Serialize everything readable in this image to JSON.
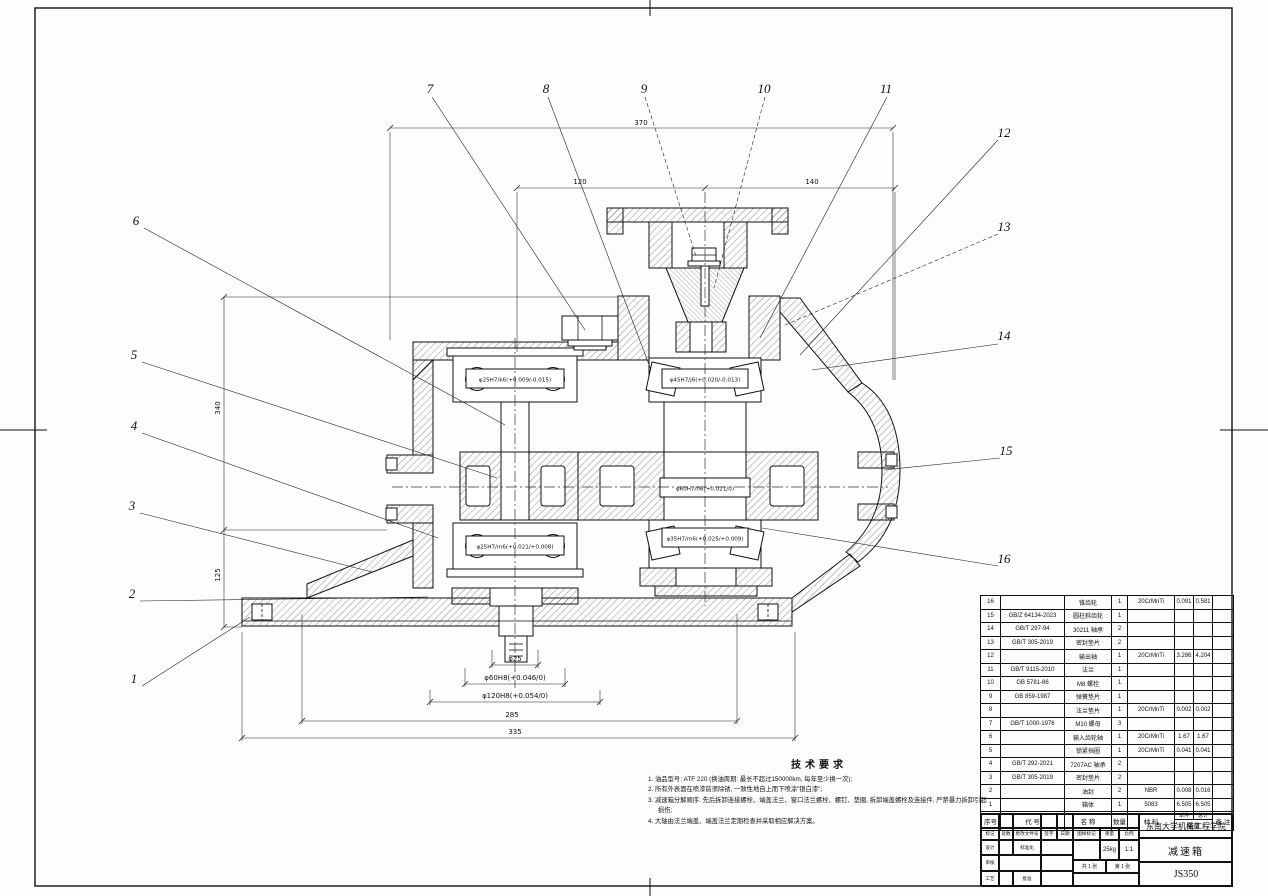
{
  "callouts": {
    "top": [
      "7",
      "8",
      "9",
      "10",
      "11"
    ],
    "right": [
      "12",
      "13",
      "14",
      "15",
      "16"
    ],
    "left": [
      "6",
      "5",
      "4",
      "3",
      "2",
      "1"
    ]
  },
  "dimensions": {
    "top_overall": "370",
    "top_left": "120",
    "top_right": "140",
    "left_upper": "340",
    "left_lower": "125",
    "bottom": [
      "φ25",
      "φ60H8(+0.046/0)",
      "φ120H8(+0.054/0)",
      "285",
      "335"
    ]
  },
  "fits": {
    "left_top": "φ25H7/k6(+0.009/-0.015)",
    "right_top": "φ45H7/j6(+0.020/-0.013)",
    "center": "φ60H7/h6(+0.021/0)",
    "right_bottom": "φ35H7/m6(+0.025/+0.009)",
    "left_bottom": "φ25H7/m6(+0.021/+0.008)"
  },
  "tech_requirements": {
    "title": "技术要求",
    "items": [
      "1. 油品型号: ATF 220 (换油周期: 最长不超过150000km, 每年至少换一次);",
      "2. 所有外表面在喷漆前须除锈, 一致性地自上而下喷涂\"银白漆\";",
      "3. 减速箱分解顺序: 先后拆卸连接螺栓、端盖法兰、窗口法兰螺栓、螺钉、垫圈, 拆卸端盖螺栓及连接件, 严禁暴力拆卸引起损伤;",
      "4. 大轴由法兰端盖、端盖法兰定期检查并采取相应解决方案。"
    ]
  },
  "bom": {
    "headers": {
      "no": "序号",
      "code": "代 号",
      "name": "名 称",
      "qty": "数量",
      "material": "材 料",
      "weight": "重量",
      "unit": "单件",
      "total": "总计",
      "remark": "备 注"
    },
    "rows": [
      {
        "no": "16",
        "code": "",
        "name": "锥齿轮",
        "qty": "1",
        "material": "20CrMnTi",
        "unit": "0.091",
        "total": "0.581",
        "remark": ""
      },
      {
        "no": "15",
        "code": "GB/Z 64134-2023",
        "name": "圆柱斜齿轮",
        "qty": "1",
        "material": "",
        "unit": "",
        "total": "",
        "remark": ""
      },
      {
        "no": "14",
        "code": "GB/T 297-94",
        "name": "30211 轴承",
        "qty": "2",
        "material": "",
        "unit": "",
        "total": "",
        "remark": ""
      },
      {
        "no": "13",
        "code": "GB/T 305-2019",
        "name": "密封垫片",
        "qty": "2",
        "material": "",
        "unit": "",
        "total": "",
        "remark": ""
      },
      {
        "no": "12",
        "code": "",
        "name": "输出轴",
        "qty": "1",
        "material": "20CrMnTi",
        "unit": "3.286",
        "total": "4.204",
        "remark": ""
      },
      {
        "no": "11",
        "code": "GB/T 9115-2010",
        "name": "法兰",
        "qty": "1",
        "material": "",
        "unit": "",
        "total": "",
        "remark": ""
      },
      {
        "no": "10",
        "code": "GB 5781-86",
        "name": "M8 螺栓",
        "qty": "1",
        "material": "",
        "unit": "",
        "total": "",
        "remark": ""
      },
      {
        "no": "9",
        "code": "GB 859-1987",
        "name": "弹簧垫片",
        "qty": "1",
        "material": "",
        "unit": "",
        "total": "",
        "remark": ""
      },
      {
        "no": "8",
        "code": "",
        "name": "法兰垫片",
        "qty": "1",
        "material": "20CrMnTi",
        "unit": "0.002",
        "total": "0.002",
        "remark": ""
      },
      {
        "no": "7",
        "code": "GB/T 1000-1976",
        "name": "M10 螺母",
        "qty": "3",
        "material": "",
        "unit": "",
        "total": "",
        "remark": ""
      },
      {
        "no": "6",
        "code": "",
        "name": "输入齿轮轴",
        "qty": "1",
        "material": "20CrMnTi",
        "unit": "1.67",
        "total": "1.67",
        "remark": ""
      },
      {
        "no": "5",
        "code": "",
        "name": "锁紧挡圈",
        "qty": "1",
        "material": "20CrMnTi",
        "unit": "0.041",
        "total": "0.041",
        "remark": ""
      },
      {
        "no": "4",
        "code": "GB/T 292-2021",
        "name": "7207AC 轴承",
        "qty": "2",
        "material": "",
        "unit": "",
        "total": "",
        "remark": ""
      },
      {
        "no": "3",
        "code": "GB/T 305-2019",
        "name": "密封垫片",
        "qty": "2",
        "material": "",
        "unit": "",
        "total": "",
        "remark": ""
      },
      {
        "no": "2",
        "code": "",
        "name": "油封",
        "qty": "2",
        "material": "NBR",
        "unit": "0.008",
        "total": "0.016",
        "remark": ""
      },
      {
        "no": "1",
        "code": "",
        "name": "箱体",
        "qty": "1",
        "material": "5083",
        "unit": "6.505",
        "total": "6.505",
        "remark": ""
      }
    ]
  },
  "title_block": {
    "org": "东南大学机械工程学院",
    "part_name": "减速箱",
    "drawing_no": "JS350",
    "stage_label": "图样标记",
    "weight_label": "重量",
    "weight": "25kg",
    "scale_label": "比例",
    "scale": "1:1",
    "sheets": "共 1 张",
    "sheet_no": "第 1 张",
    "fields": {
      "mark": "标记",
      "count": "处数",
      "doc_no": "更改文件号",
      "sign": "签字",
      "date": "日期",
      "design": "设计",
      "check": "审核",
      "process": "工艺",
      "standard": "标准化",
      "approve": "批准"
    }
  }
}
